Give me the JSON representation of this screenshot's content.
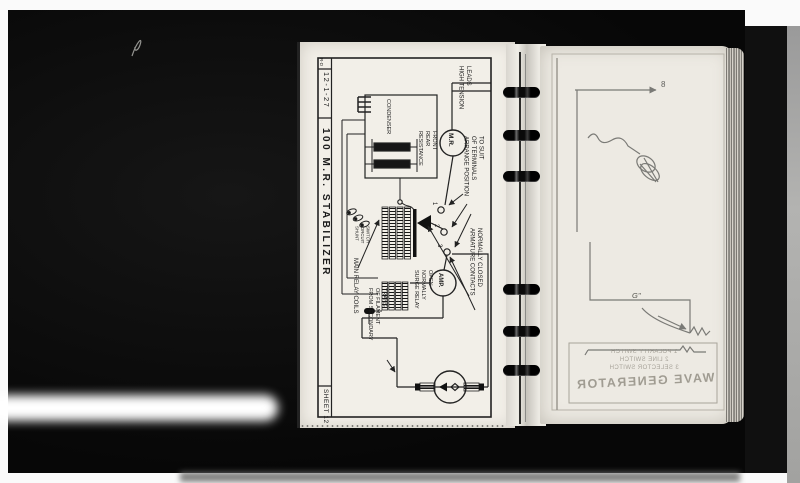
{
  "left_page": {
    "corner_mark": "R-D",
    "date": "12-1-27",
    "title": "100 M.R. STABILIZER",
    "sheet": "SHEET 12",
    "labels": {
      "high_tension": "HIGH TENSION\nLEADS",
      "condenser": "CONDENSER",
      "resistance": "RESISTANCE\nREAR\nFRONT",
      "arrange": "ARRANGE POSITION\nOF TERMINALS\nTO SUIT",
      "armature": "ARMATURE CONTACTS\nNORMALLY CLOSED",
      "surge": "SURGE RELAY\nNORMALLY\nOPEN",
      "main_relay": "MAIN RELAY COILS",
      "from_secondary": "FROM SECONDARY\nOF FILAMENT\nTRANS.",
      "shunt": "SHUNT\nCIRCUIT\nSWITCH"
    },
    "meters": {
      "mr": "M.R.",
      "amp": "AMP."
    },
    "terminals": [
      "1",
      "2",
      "3"
    ]
  },
  "right_page": {
    "figure_number": "8",
    "g_label": "G''",
    "bleedthrough": {
      "lines": [
        "1 POLARITY SWITCH",
        "2 LINE SWITCH",
        "3 SELECTOR SWITCH"
      ],
      "title": "WAVE GENERATOR"
    }
  },
  "colors": {
    "ink": "#222222",
    "paper_left": "#f2efe8",
    "paper_right": "#edeae3",
    "scan_background": "#0c0c0c",
    "pencil": "#7a7a76"
  }
}
